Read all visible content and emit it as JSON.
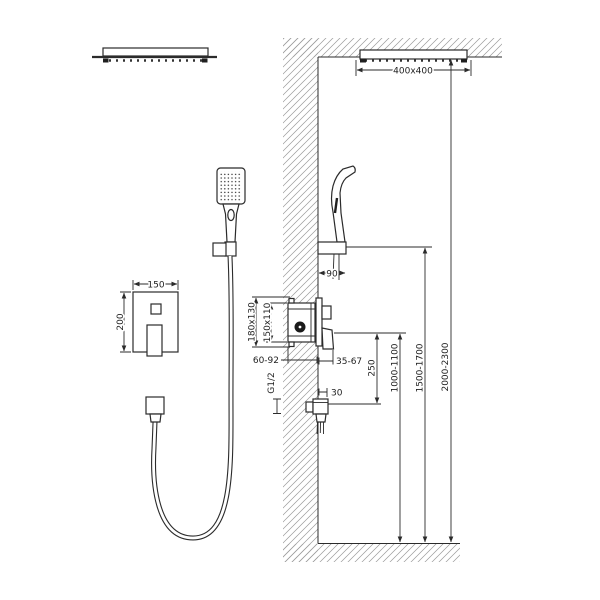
{
  "drawing": {
    "type": "shower-system-installation-diagram",
    "colors": {
      "line": "#2b2b2b",
      "hatch": "#9a9a9a",
      "background": "#ffffff",
      "text": "#222222"
    },
    "dimensions": {
      "ceiling_head_size": "400x400",
      "hand_shower_wall_offset": "90",
      "plate_width": "150",
      "plate_height": "200",
      "rough_in_box_outer": "180x130",
      "rough_in_box_inner": "150x110",
      "embed_depth_range": "60-92",
      "trim_projection_range": "35-67",
      "outlet_thread": "G1/2",
      "outlet_projection": "30",
      "mixer_to_outlet_distance": "250",
      "mixer_height_range": "1000-1100",
      "hand_shower_height_range": "1500-1700",
      "head_shower_height_range": "2000-2300"
    }
  }
}
